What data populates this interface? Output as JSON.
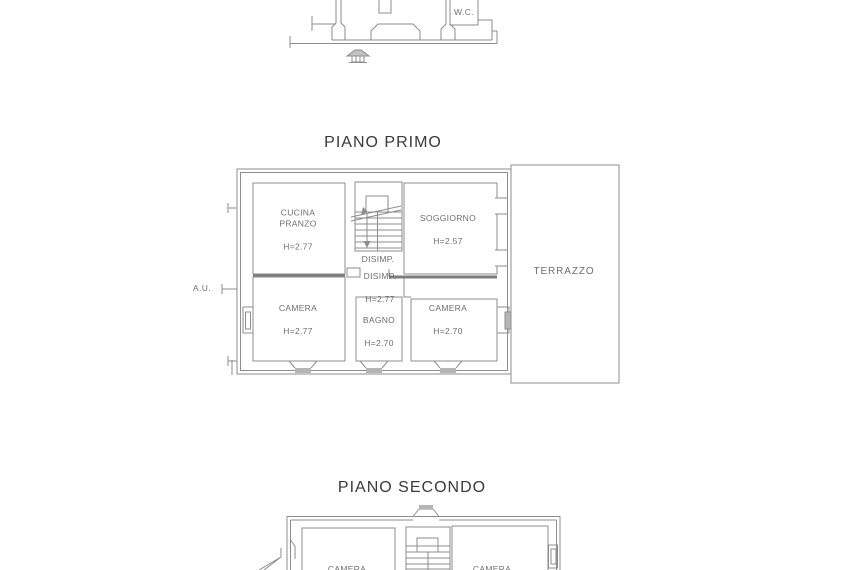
{
  "palette": {
    "background": "#ffffff",
    "line": "#8d8d8d",
    "thick_wall": "#7d7d7d",
    "label_text": "#6f6f6f",
    "title_text": "#3a3a3a",
    "sill_fill": "#b5b5b5"
  },
  "titles": {
    "first_floor": "PIANO PRIMO",
    "second_floor": "PIANO SECONDO"
  },
  "ground_floor_fragment": {
    "wc": "W.C.",
    "icons": {
      "roof_vent": "roof-vent-icon"
    }
  },
  "piano_primo": {
    "access_label": "A.U.",
    "rooms": {
      "cucina": {
        "name": "CUCINA\nPRANZO",
        "height": "H=2.77"
      },
      "soggiorno": {
        "name": "SOGGIORNO",
        "height": "H=2.57"
      },
      "disimpegno_upper": {
        "name": "DISIMP."
      },
      "disimpegno_lower": {
        "name": "DISIMP.",
        "height": "H=2.77"
      },
      "camera_left": {
        "name": "CAMERA",
        "height": "H=2.77"
      },
      "bagno": {
        "name": "BAGNO",
        "height": "H=2.70"
      },
      "camera_right": {
        "name": "CAMERA",
        "height": "H=2.70"
      },
      "terrazzo": {
        "name": "TERRAZZO"
      }
    }
  },
  "piano_secondo": {
    "rooms": {
      "camera_left": {
        "name": "CAMERA"
      },
      "camera_right": {
        "name": "CAMERA"
      }
    }
  }
}
